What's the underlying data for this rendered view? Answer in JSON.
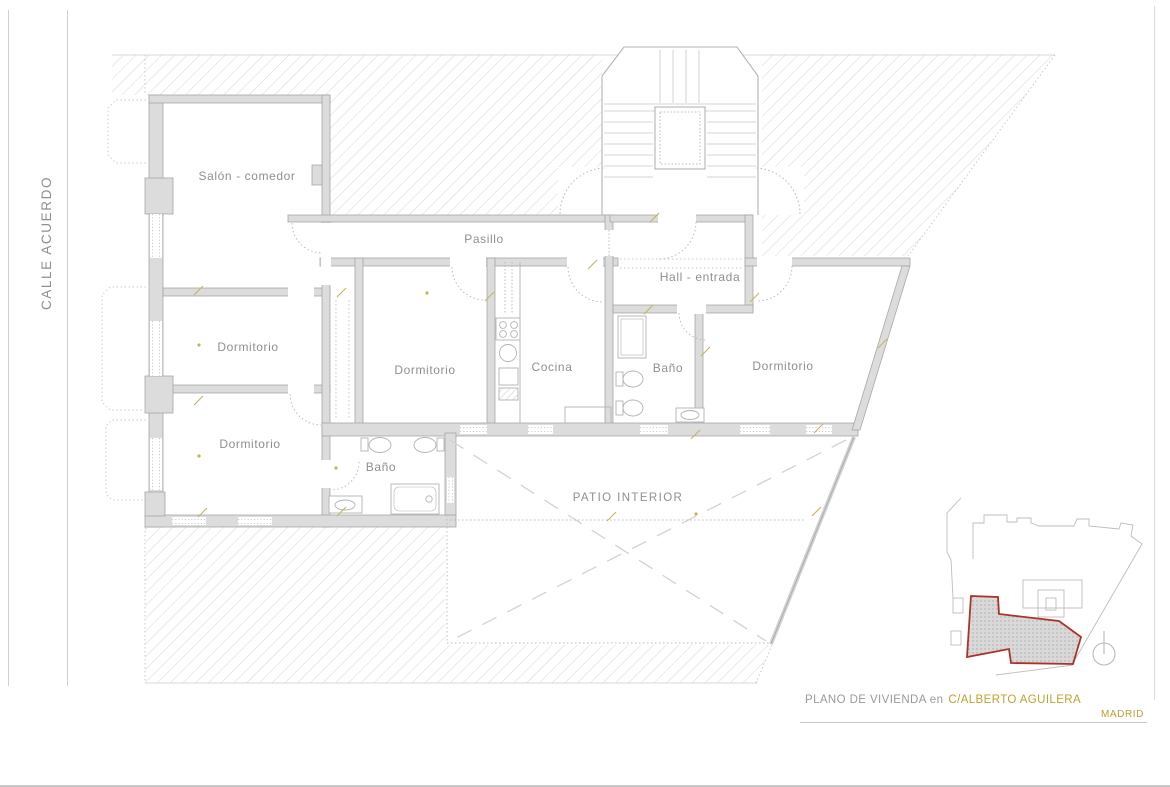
{
  "street_label": "CALLE ACUERDO",
  "rooms": {
    "salon": "Salón - comedor",
    "pasillo": "Pasillo",
    "dormitorio_left_mid": "Dormitorio",
    "dormitorio_left_low": "Dormitorio",
    "dormitorio_center": "Dormitorio",
    "cocina": "Cocina",
    "bano_center": "Baño",
    "hall": "Hall - entrada",
    "bano_right": "Baño",
    "dormitorio_right": "Dormitorio",
    "patio": "PATIO INTERIOR"
  },
  "footer": {
    "title_prefix": "PLANO DE VIVIENDA en",
    "title_street": "C/ALBERTO AGUILERA",
    "city": "MADRID"
  },
  "colors": {
    "accent_gold": "#bfa130",
    "highlight_red": "#ab3229",
    "wall_gray": "#dcdcdc",
    "hatch_gray": "#d6d6d6",
    "label_gray": "#8f8f8f"
  },
  "icons": {
    "north_indicator": "compass-circle"
  }
}
